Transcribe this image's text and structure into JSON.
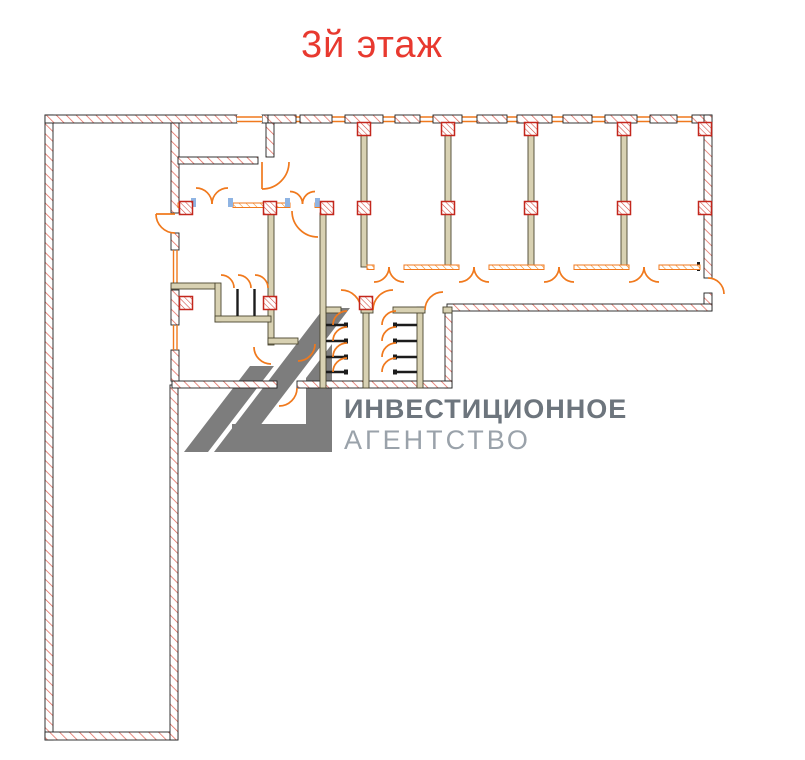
{
  "title": {
    "text": "3й этаж",
    "color": "#e8392f"
  },
  "watermark": {
    "line1": "ИНВЕСТИЦИОННОЕ",
    "line2": "АГЕНТСТВО",
    "line1_color": "#6d757d",
    "line2_color": "#9aa2aa",
    "mark_color": "#7d7d7d"
  },
  "plan": {
    "floor_label": "3й этаж",
    "colors": {
      "wall_hatch_red": "#e2675a",
      "wall_outline": "#1e1e1e",
      "partition_fill": "#d8d1b2",
      "partition_outline": "#4a452f",
      "accent_orange": "#f0791d",
      "door_jamb_blue": "#8fb4e3",
      "column_red": "#c3271d",
      "stall_partition_black": "#1c1c1c"
    },
    "features": {
      "office_partitions": 4,
      "double_doors_to_corridor": 4,
      "toilet_stall_banks": 2,
      "stall_doors_per_bank": 4,
      "closets": 3,
      "column_markers": 16,
      "exterior_doors": 3
    }
  }
}
